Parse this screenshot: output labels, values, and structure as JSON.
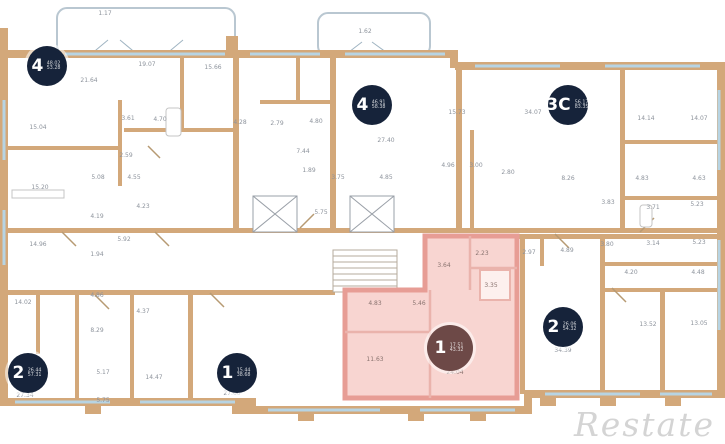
{
  "watermark": "Restate",
  "badges": [
    {
      "rooms": "4",
      "area_living": "48.02",
      "area_total": "53.28"
    },
    {
      "rooms": "4",
      "area_living": "46.91",
      "area_total": "58.38"
    },
    {
      "rooms": "3C",
      "area_living": "56.17",
      "area_total": "83.35"
    },
    {
      "rooms": "2",
      "area_living": "26.44",
      "area_total": "57.31"
    },
    {
      "rooms": "1",
      "area_living": "15.44",
      "area_total": "38.68"
    },
    {
      "rooms": "1",
      "area_living": "17.51",
      "area_total": "43.32"
    },
    {
      "rooms": "2",
      "area_living": "26.06",
      "area_total": "54.32"
    }
  ],
  "room_labels": [
    "1.17",
    "1.62",
    "21.64",
    "19.07",
    "15.66",
    "15.04",
    "3.61",
    "4.70",
    "2.59",
    "5.08",
    "4.55",
    "4.23",
    "4.19",
    "5.92",
    "14.96",
    "15.20",
    "4.28",
    "2.79",
    "4.80",
    "27.40",
    "15.73",
    "7.44",
    "1.89",
    "3.75",
    "4.85",
    "4.96",
    "5.75",
    "34.07",
    "14.14",
    "14.07",
    "3.00",
    "2.80",
    "8.26",
    "4.83",
    "4.63",
    "3.83",
    "3.71",
    "5.23",
    "2.97",
    "4.89",
    "3.80",
    "3.14",
    "5.23",
    "4.20",
    "4.48",
    "34.39",
    "13.52",
    "13.05",
    "2.23",
    "3.64",
    "3.35",
    "4.83",
    "5.46",
    "11.63",
    "24.04",
    "14.02",
    "1.94",
    "4.86",
    "8.29",
    "4.37",
    "27.34",
    "5.17",
    "14.47",
    "5.75",
    "27.60"
  ]
}
